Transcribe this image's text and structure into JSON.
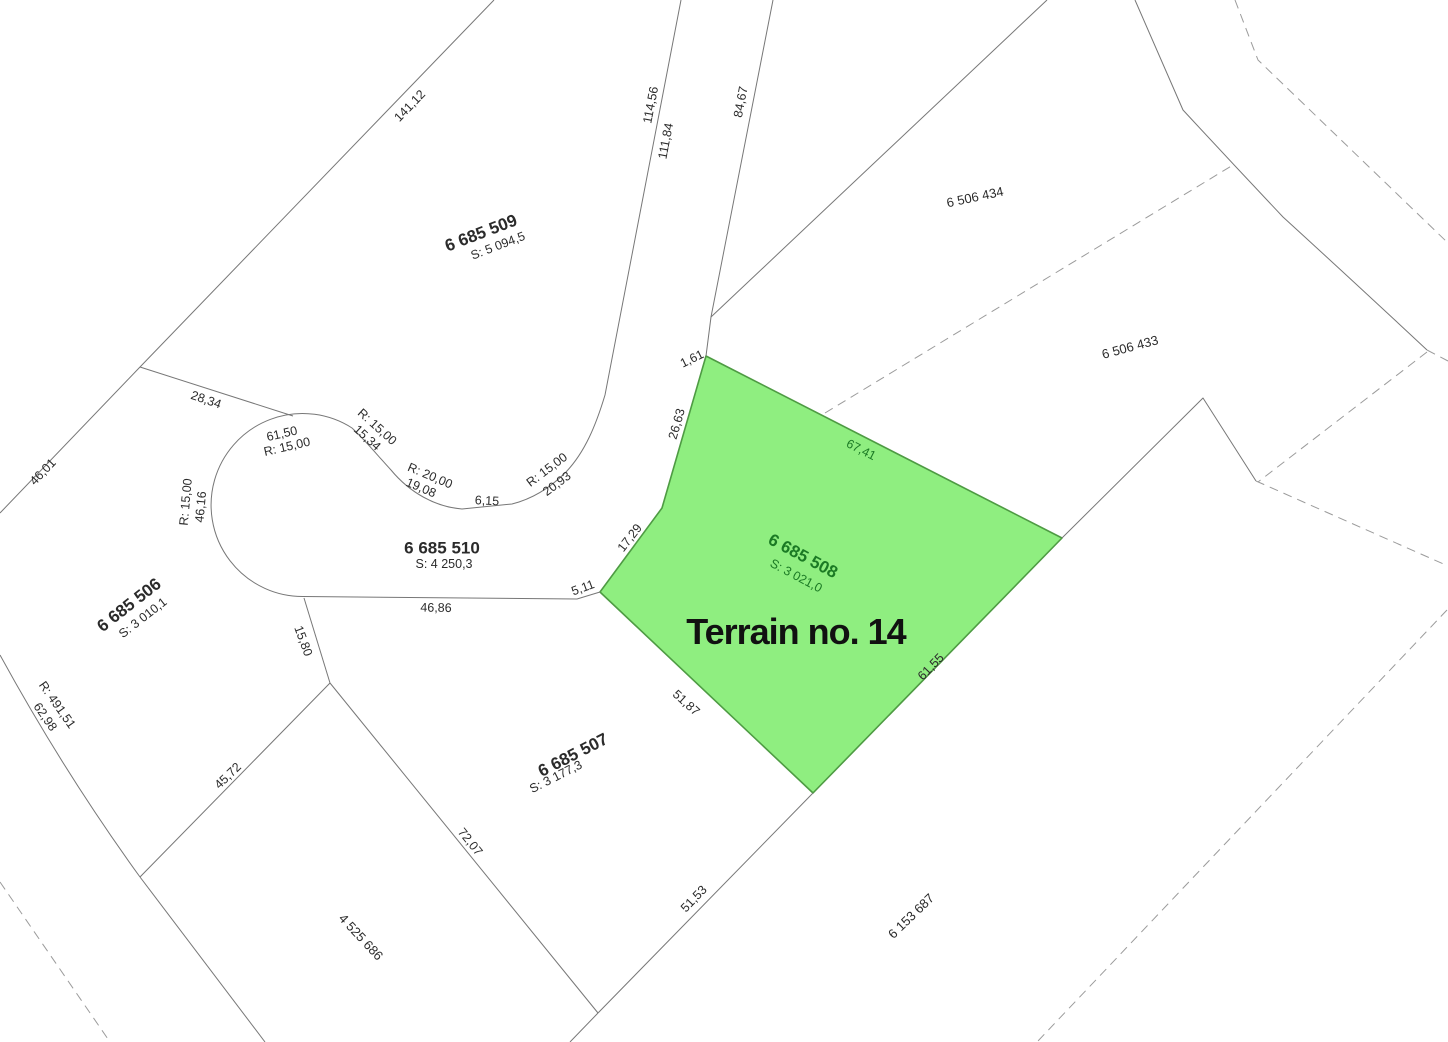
{
  "title": "Terrain no. 14",
  "colors": {
    "parcel-fill": "#8FEE80",
    "parcel-stroke": "#4E9B43",
    "parcel-text": "#1B7A24",
    "line": "#777777",
    "dash": "#9B9B9B",
    "text": "#2B2B2B",
    "bg": "#FFFFFF"
  },
  "selected_parcel": {
    "number": "6 685 508",
    "area": "S: 3 021,0",
    "name": "Terrain no. 14"
  },
  "parcels": {
    "p509": {
      "number": "6 685 509",
      "area": "S: 5 094,5"
    },
    "p510": {
      "number": "6 685 510",
      "area": "S: 4 250,3"
    },
    "p506": {
      "number": "6 685 506",
      "area": "S: 3 010,1"
    },
    "p507": {
      "number": "6 685 507",
      "area": "S: 3 177,3"
    },
    "p434": {
      "number": "6 506 434"
    },
    "p433": {
      "number": "6 506 433"
    },
    "p4525686": {
      "number": "4 525 686"
    },
    "p6153687": {
      "number": "6 153 687"
    }
  },
  "dims": {
    "d141_12": "141,12",
    "d114_56": "114,56",
    "d111_84": "111,84",
    "d84_67": "84,67",
    "d1_61": "1,61",
    "d26_63": "26,63",
    "d67_41": "67,41",
    "d17_29": "17,29",
    "d5_11": "5,11",
    "d46_86": "46,86",
    "d28_34": "28,34",
    "d61_50": "61,50",
    "r15_a": "R: 15,00",
    "r15_b": "R: 15,00",
    "d15_34": "15,34",
    "r20_00": "R: 20,00",
    "d19_08": "19,08",
    "d6_15": "6,15",
    "r15_c": "R: 15,00",
    "d20_93": "20,93",
    "r15_d": "R: 15,00",
    "d46_16": "46,16",
    "d46_01": "46,01",
    "d15_80": "15,80",
    "d45_72": "45,72",
    "d72_07": "72,07",
    "d51_53": "51,53",
    "d51_87": "51,87",
    "d61_55": "61,55",
    "r491_51": "R: 491,51",
    "d62_98": "62,98"
  }
}
